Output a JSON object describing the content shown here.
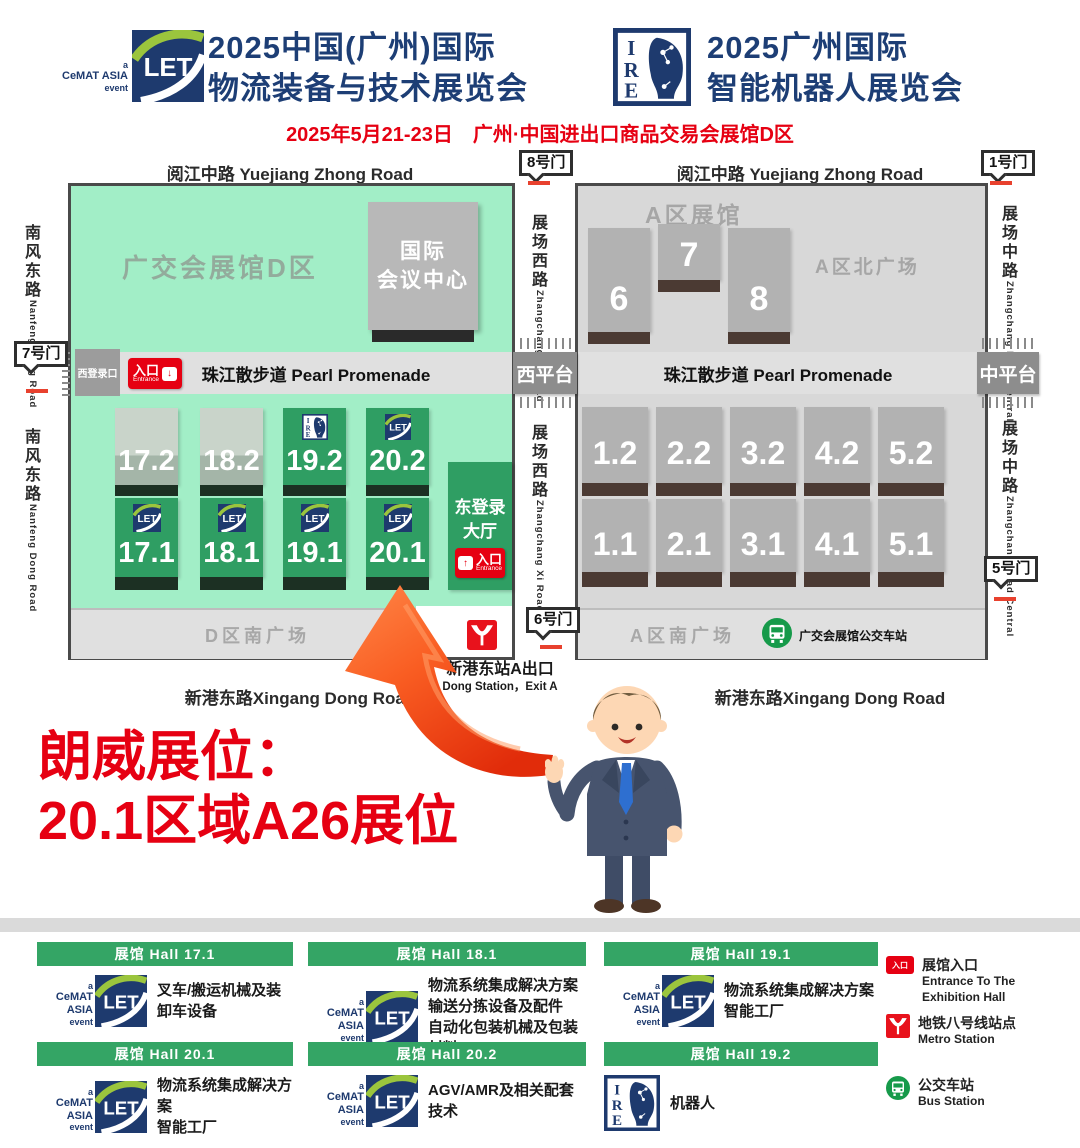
{
  "header": {
    "logo_caption_a": "a",
    "logo_caption_name": "CeMAT ASIA",
    "logo_caption_event": "event",
    "left_title_line1": "2025中国(广州)国际",
    "left_title_line2": "物流装备与技术展览会",
    "right_title_line1": "2025广州国际",
    "right_title_line2": "智能机器人展览会",
    "date_line": "2025年5月21-23日　广州·中国进出口商品交易会展馆D区"
  },
  "map": {
    "roads": {
      "yuejiang": "阅江中路 Yuejiang Zhong Road",
      "nanfeng_cn": "南风东路",
      "nanfeng_en": "Nanfeng Dong Road",
      "zhangchang_xi_cn": "展场西路",
      "zhangchang_xi_en": "Zhangchang Xi Road",
      "zhangchang_central_cn": "展场中路",
      "zhangchang_central_en": "Zhangchang Road Central",
      "xingang": "新港东路Xingang Dong Road"
    },
    "gates": {
      "gate1": "1号门",
      "gate5": "5号门",
      "gate6": "6号门",
      "gate7": "7号门",
      "gate8": "8号门"
    },
    "areas": {
      "d_area": "广交会展馆D区",
      "conference_line1": "国际",
      "conference_line2": "会议中心",
      "a_area": "A区展馆",
      "a_north_plaza": "A区北广场",
      "d_south_plaza": "D区南广场",
      "a_south_plaza": "A区南广场",
      "west_platform": "西平台",
      "central_platform": "中平台",
      "west_login": "西登录口",
      "east_hall_line1": "东登录",
      "east_hall_line2": "大厅"
    },
    "promenade": "珠江散步道 Pearl Promenade",
    "entrance_cn": "入口",
    "entrance_en": "Entrance",
    "bus_station_label": "广交会展馆公交车站",
    "metro_exit_cn": "新港东站A出口",
    "metro_exit_en": "Dong Station，Exit A",
    "halls_d_row2": [
      "17.2",
      "18.2",
      "19.2",
      "20.2"
    ],
    "halls_d_row1": [
      "17.1",
      "18.1",
      "19.1",
      "20.1"
    ],
    "halls_a_north": [
      "6",
      "7",
      "8"
    ],
    "halls_a_row2": [
      "1.2",
      "2.2",
      "3.2",
      "4.2",
      "5.2"
    ],
    "halls_a_row1": [
      "1.1",
      "2.1",
      "3.1",
      "4.1",
      "5.1"
    ]
  },
  "announcement": {
    "line1": "朗威展位：",
    "line2": "20.1区域A26展位"
  },
  "legend": {
    "cards": [
      {
        "hall": "展馆 Hall  17.1",
        "logo": "let",
        "lines": [
          "叉车/搬运机械及装卸车设备"
        ]
      },
      {
        "hall": "展馆 Hall  18.1",
        "logo": "let",
        "lines": [
          "物流系统集成解决方案",
          "输送分拣设备及配件",
          "自动化包装机械及包装材料"
        ]
      },
      {
        "hall": "展馆 Hall  19.1",
        "logo": "let",
        "lines": [
          "物流系统集成解决方案",
          "智能工厂"
        ]
      },
      {
        "hall": "展馆 Hall  20.1",
        "logo": "let",
        "lines": [
          "物流系统集成解决方案",
          "智能工厂"
        ]
      },
      {
        "hall": "展馆 Hall  20.2",
        "logo": "let",
        "lines": [
          "AGV/AMR及相关配套技术"
        ]
      },
      {
        "hall": "展馆 Hall  19.2",
        "logo": "ire",
        "lines": [
          "机器人"
        ]
      }
    ],
    "key": {
      "entrance_cn": "展馆入口",
      "entrance_en": "Entrance To The Exhibition Hall",
      "metro_cn": "地铁八号线站点",
      "metro_en": "Metro Station",
      "bus_cn": "公交车站",
      "bus_en": "Bus Station"
    }
  },
  "colors": {
    "accent_red": "#e60012",
    "navy": "#1d3e75",
    "hall_green": "#2f9e63",
    "mint_green": "#a2eec7",
    "legend_header_green": "#34a565",
    "bus_green": "#169a4a"
  },
  "icons": {
    "let_logo": "CeMAT ASIA LET logo",
    "ire_logo": "IRE intelligent robot expo logo",
    "metro_icon": "Guangzhou Metro mark",
    "bus_icon": "bus station",
    "entrance_icon": "entrance arrow badge",
    "arrow": "booth location arrow",
    "mascot": "suited presenter mascot"
  }
}
